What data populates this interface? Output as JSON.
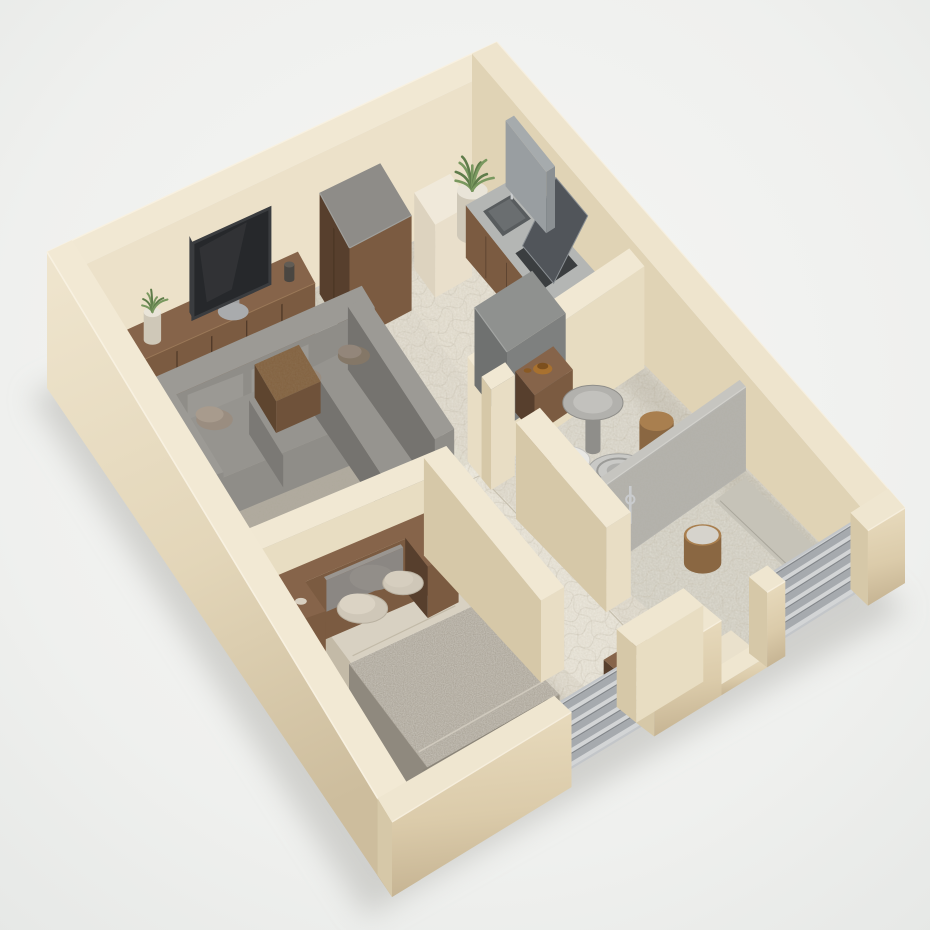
{
  "scene": {
    "type": "isometric-3d-floor-plan-render",
    "description": "Photorealistic 3D dollhouse cutaway model of a one-bedroom apartment viewed from above at an angle, with cream plaster walls, mosaic stone tile floors, and gray slatted shutter windows on the front walls",
    "rooms": [
      {
        "name": "Living room",
        "furniture": [
          "wood TV sideboard",
          "flat-screen television",
          "small potted plant",
          "tall wood dresser with gray top",
          "gray L-shaped sectional sofa",
          "taupe throw pillows",
          "wood coffee tray table",
          "gray area rug"
        ]
      },
      {
        "name": "Kitchen",
        "furniture": [
          "corner potted plant",
          "white cabinet block",
          "wood counter with steel top",
          "inset sink with faucet",
          "dark cooktop with leaned panel",
          "gray backsplash panel",
          "gray refrigerator cube",
          "wood side table with bronze bowl"
        ]
      },
      {
        "name": "Bathroom",
        "furniture": [
          "white wall basin with chrome pipe",
          "round steel pedestal table",
          "toilet with concentric bowl",
          "wood stools",
          "textured stone shower partition",
          "shower area with drain"
        ]
      },
      {
        "name": "Bedroom",
        "furniture": [
          "double bed with cream sheets",
          "wood headboard with built-in nightstands",
          "gray headboard cushion",
          "cream pillows",
          "knitted gray blanket",
          "wood foot chest"
        ]
      },
      {
        "name": "Hallway",
        "furniture": [
          "mosaic tile runner path",
          "wood console cabinet with glassware"
        ]
      }
    ],
    "openings": [
      "bedroom slatted shutter window",
      "shower slatted shutter window",
      "recessed entry doorway with step"
    ]
  },
  "palette": {
    "background": "#eff0ee",
    "shadow": "#c3c3bf",
    "wall_top": "#f1e8d3",
    "wall_inner_lit": "#ece1c9",
    "wall_inner_mid": "#e0d3b5",
    "wall_inner_shadow": "#d6c8a8",
    "wall_end": "#e8ddc4",
    "floor_tile": "#dcd6c8",
    "floor_tile_light": "#e7e2d5",
    "floor_bath": "#d6d2c6",
    "floor_shower": "#cfccc0",
    "grout": "#c6bfae",
    "rug": "#c7c2b6",
    "wood": "#7b5b41",
    "wood_dark": "#573f2d",
    "wood_top": "#86644a",
    "sofa": "#8f8d88",
    "sofa_light": "#9c9a95",
    "sofa_dark": "#75736f",
    "cushion": "#9a8d80",
    "cushion_dark": "#847767",
    "bed_sheet": "#d8d1c2",
    "blanket": "#a49e93",
    "blanket_dark": "#8f897e",
    "pillow": "#cfc7b8",
    "headboard_cushion": "#8b8783",
    "appliance": "#7e807f",
    "appliance_dark": "#6f7170",
    "appliance_light": "#8f918f",
    "steel": "#b4b6b4",
    "chrome": "#c9cbcd",
    "tv_screen": "#26282b",
    "tv_frame": "#3a3c3f",
    "window_frame": "#c3c6c9",
    "window_slat": "#a6aaae",
    "window_slat_dark": "#83878b",
    "window_recess": "#d3d5d6",
    "plant_green": "#5f7c4a",
    "plant_green_light": "#79985f",
    "pot": "#e9e4d8",
    "pot_dark": "#cfc8b8",
    "partition": "#b4b3ae",
    "partition_light": "#c6c5c0",
    "ceramic": "#e9e8e4",
    "bronze": "#a8712f",
    "glass": "#dfe3e3"
  }
}
